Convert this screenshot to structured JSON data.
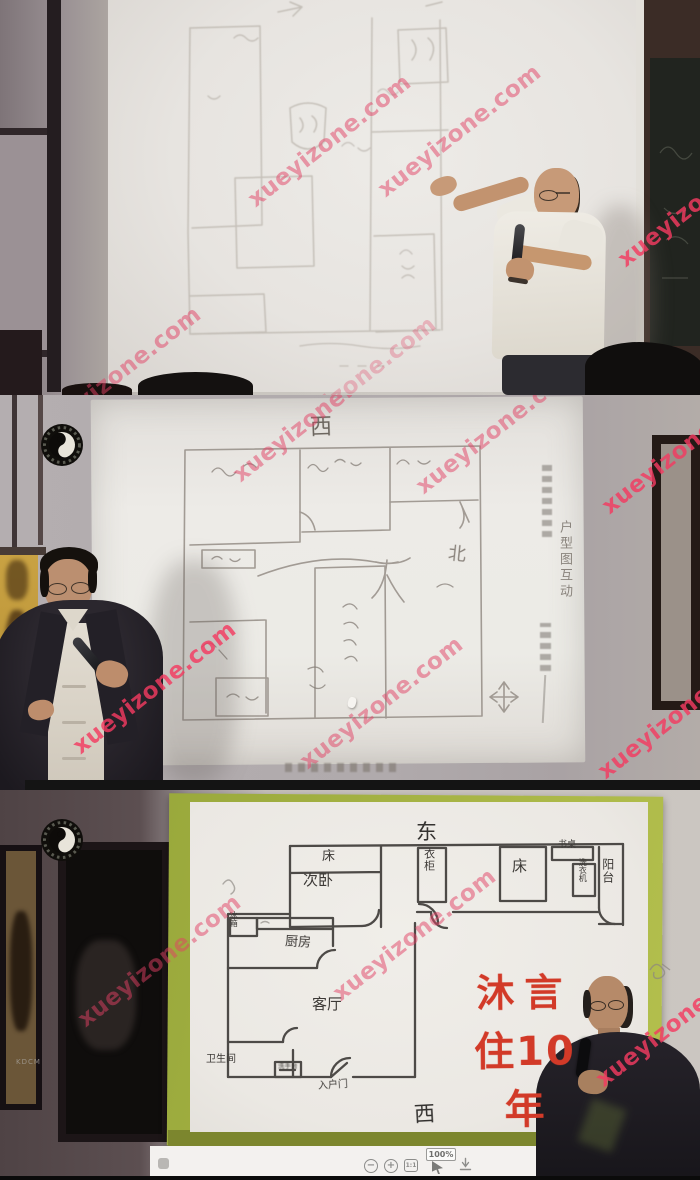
{
  "watermark": {
    "text": "xueyizone.com"
  },
  "icons": {
    "logo": "taiji-icon",
    "zoom_out": "magnifier-minus-icon",
    "zoom_in": "magnifier-plus-icon",
    "actual_size": "one-to-one-icon",
    "cursor": "cursor-icon",
    "download": "download-icon"
  },
  "middle_panel": {
    "compass_top": "西",
    "compass_right": "北",
    "slide_side_caption": "户型图互动"
  },
  "bottom_panel": {
    "compass_top": "东",
    "compass_bottom": "西",
    "red_caption_line1": "沐言",
    "red_caption_line2": "住10年",
    "camera_mark": "KDCM",
    "rooms": {
      "bed_left": "床",
      "secondary_bedroom": "次卧",
      "wardrobe": "衣柜",
      "bed_right": "床",
      "desk": "书桌",
      "washing_machine": "洗衣机",
      "balcony": "阳台",
      "fridge": "冰箱",
      "kitchen": "厨房",
      "living_room": "客厅",
      "bathroom": "卫生间",
      "washstand": "洗手台",
      "entry_door": "入户门"
    },
    "toolbar": {
      "zoom_out_glyph": "−",
      "zoom_in_glyph": "+",
      "actual_size_label": "1:1",
      "zoom_level": "100%"
    }
  },
  "colors": {
    "watermark_pink": "#e24064",
    "red_caption": "#d23a28",
    "board_green": "#a2b03e",
    "marker_line": "#403d3a"
  }
}
